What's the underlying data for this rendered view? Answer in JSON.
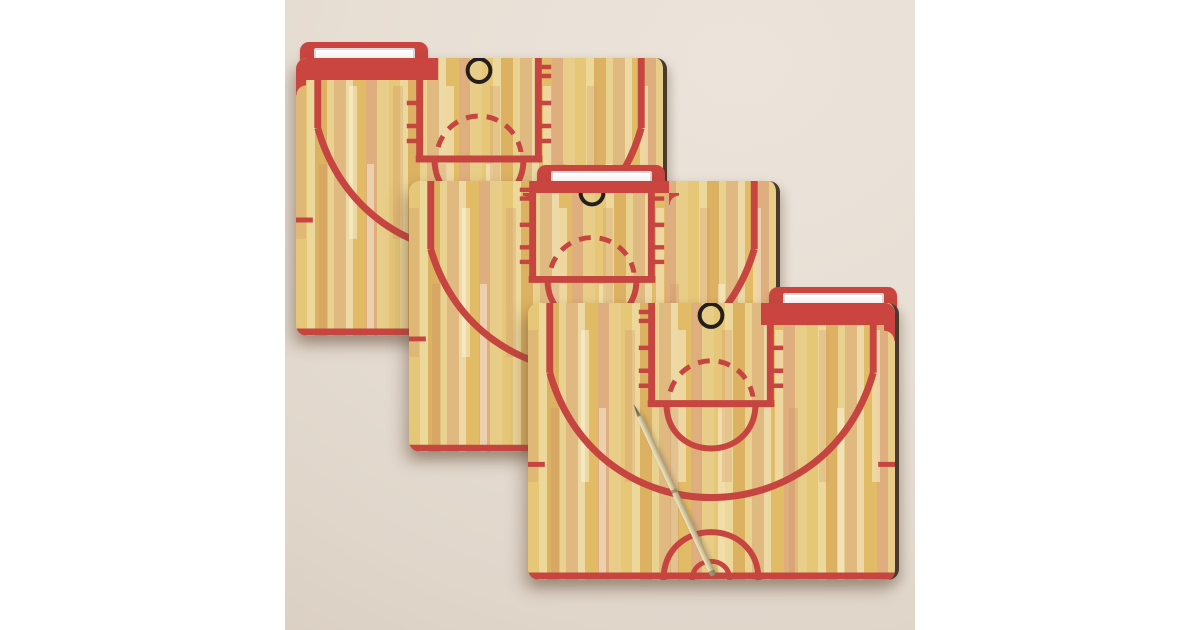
{
  "scene": {
    "description": "Product photo of three basketball-court file folders fanned diagonally on a beige desk with two gold binder clips and a gold pen",
    "background_color": "#e6ddd2",
    "side_panel_color": "#ffffff",
    "folder_design": {
      "theme": "basketball half-court printed on wood parquet floor",
      "tab_color": "#ca4540",
      "court_line_color": "#c64540",
      "wood_base_color": "#e2c06e",
      "hoop_ring_color": "#241f1c",
      "label_color": "#fbfbfb"
    },
    "folders": [
      {
        "id": "back",
        "tab_position": "left",
        "label_text": ""
      },
      {
        "id": "middle",
        "tab_position": "center",
        "label_text": ""
      },
      {
        "id": "front",
        "tab_position": "right",
        "label_text": ""
      }
    ],
    "props": {
      "binder_clips": {
        "count": 2,
        "color": "gold"
      },
      "pen": {
        "count": 1,
        "color": "gold"
      }
    }
  }
}
